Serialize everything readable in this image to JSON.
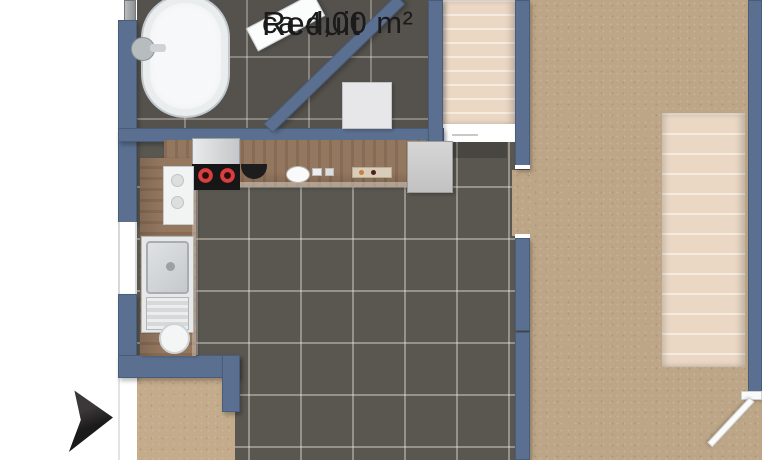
{
  "room_labels": {
    "reduit": {
      "name": "Reduit",
      "area": "ca.4,00 m²"
    }
  },
  "colors": {
    "wall": "#5b7090",
    "tile_floor": "#5a5751",
    "bath_tile_floor": "#55524d",
    "wood_floor": "#bda687",
    "entrance_floor": "#c3ab8b",
    "counter_wood": "#94775f",
    "stair_tread_light": "#f5ebdf",
    "stair_tread_dark": "#ead7c4",
    "arrow": "#1a1a1a",
    "label_text": "#1b1b1b"
  },
  "icons": {
    "entrance_arrow": "right-pointing-arrow"
  }
}
